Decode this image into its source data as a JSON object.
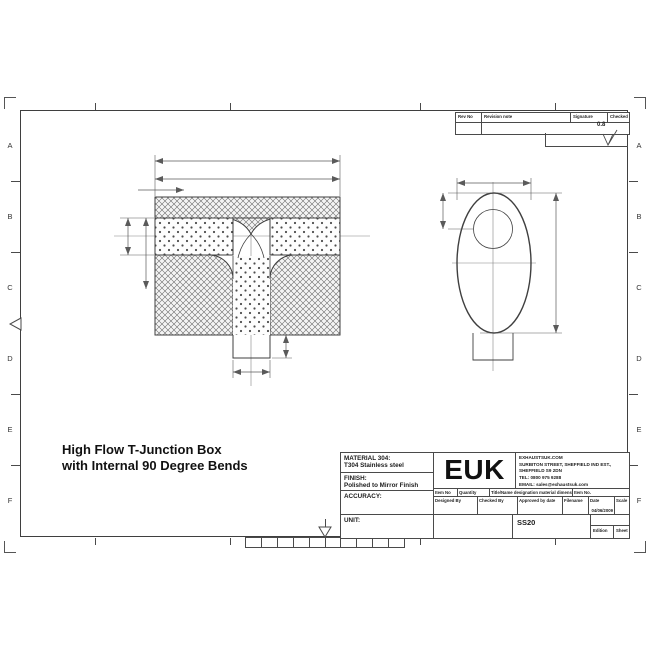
{
  "drawing_title": {
    "line1": "High Flow T-Junction Box",
    "line2": "with Internal 90 Degree Bends"
  },
  "grid": {
    "row_letters": [
      "A",
      "B",
      "C",
      "D",
      "E",
      "F"
    ]
  },
  "revision_table": {
    "headers": [
      "Rev No",
      "Revision note",
      "Signature",
      "Checked"
    ]
  },
  "surface_finish": {
    "value": "0.8"
  },
  "title_block": {
    "material_label": "MATERIAL 304:",
    "material_value": "T304 Stainless steel",
    "finish_label": "FINISH:",
    "finish_value": "Polished to Mirror Finish",
    "accuracy_label": "ACCURACY:",
    "unit_label": "UNIT:",
    "logo": "EUK",
    "company": {
      "line1": "EXHAUSTSUK.COM",
      "line2": "SURBITON STREET, SHEFFIELD IND EST.,",
      "line3": "SHEFFIELD S9 2DN",
      "line4": "TEL: 0800 975 9288",
      "line5": "EMAIL: sales@exhaustsuk.com"
    },
    "row1": {
      "c1": "Item No",
      "c2": "Quantity",
      "c3": "Title/Name designation material dimensions",
      "c4": "Item No."
    },
    "row2": {
      "c1": "Designed By",
      "c2": "Checked By",
      "c3": "Approved by date",
      "c4": "Filename",
      "c5": "Date",
      "c6": "Scale"
    },
    "date_value": "04/06/2009",
    "part_number": "SS20",
    "edition_label": "Edition",
    "sheet_label": "Sheet"
  }
}
